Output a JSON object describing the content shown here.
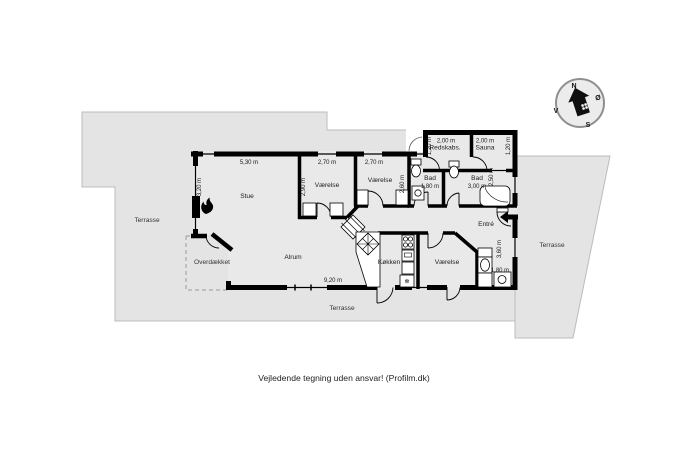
{
  "caption": "Vejledende tegning uden ansvar! (Profilm.dk)",
  "compass": {
    "north": "N",
    "east": "Ø",
    "south": "S",
    "west": "V"
  },
  "areas": {
    "terrace_left": "Terrasse",
    "terrace_right": "Terrasse",
    "terrace_bottom": "Terrasse",
    "covered": "Overdækket"
  },
  "rooms": {
    "living": "Stue",
    "family": "Alrum",
    "kitchen": "Køkken",
    "bedroom1": "Værelse",
    "bedroom2": "Værelse",
    "bedroom3": "Værelse",
    "bath1": "Bad",
    "bath2": "Bad",
    "entry": "Entré",
    "tools": "Redskabs.",
    "sauna": "Sauna"
  },
  "measurements": {
    "living_width": "5,30 m",
    "living_depth": "3,20 m",
    "bedroom1_width": "2,70 m",
    "bedroom1_depth": "2,90 m",
    "bedroom2_width": "2,70 m",
    "bedroom2_depth": "2,60 m",
    "bath1_width": "1,80 m",
    "bath2_width": "3,00 m",
    "bath2_depth": "2,50 m",
    "tools_width": "2,00 m",
    "tools_depth": "1,20 m",
    "sauna_width": "2,00 m",
    "sauna_depth": "1,20 m",
    "family_width": "9,20 m",
    "entry_depth": "3,60 m",
    "entry_width": "1,80 m"
  },
  "icons": {
    "freezer": "❄"
  },
  "colors": {
    "terrace": "#e4e4e4",
    "floor": "#e9e9e9",
    "wall": "#000000",
    "fixture": "#ffffff",
    "dash": "#9a9a9a"
  }
}
